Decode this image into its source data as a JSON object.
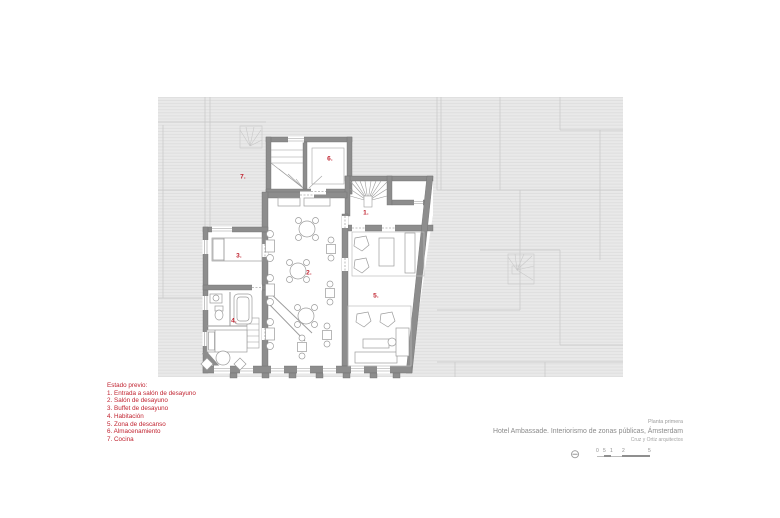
{
  "palette": {
    "accent_red": "#c0222f",
    "wall_gray": "#8d8d8d",
    "context_gray": "#e9e9e9",
    "text_gray": "#8b8b8b"
  },
  "plan": {
    "room_labels": [
      "1.",
      "2.",
      "3.",
      "4.",
      "5.",
      "6.",
      "7."
    ]
  },
  "legend": {
    "title": "Estado previo:",
    "items": [
      "1. Entrada a salón de desayuno",
      "2. Salón de desayuno",
      "3. Buffet de desayuno",
      "4. Habitación",
      "5. Zona de descanso",
      "6. Almacenamiento",
      "7. Cocina"
    ]
  },
  "titleblock": {
    "plan_name": "Planta primera",
    "project_title": "Hotel Ambassade. Interiorismo de zonas públicas, Ámsterdam",
    "architects": "Cruz y Ortiz arquitectos"
  },
  "scalebar": {
    "compass_glyph": "⊖",
    "labels": [
      "0",
      "5",
      "1",
      "2",
      "5"
    ]
  }
}
